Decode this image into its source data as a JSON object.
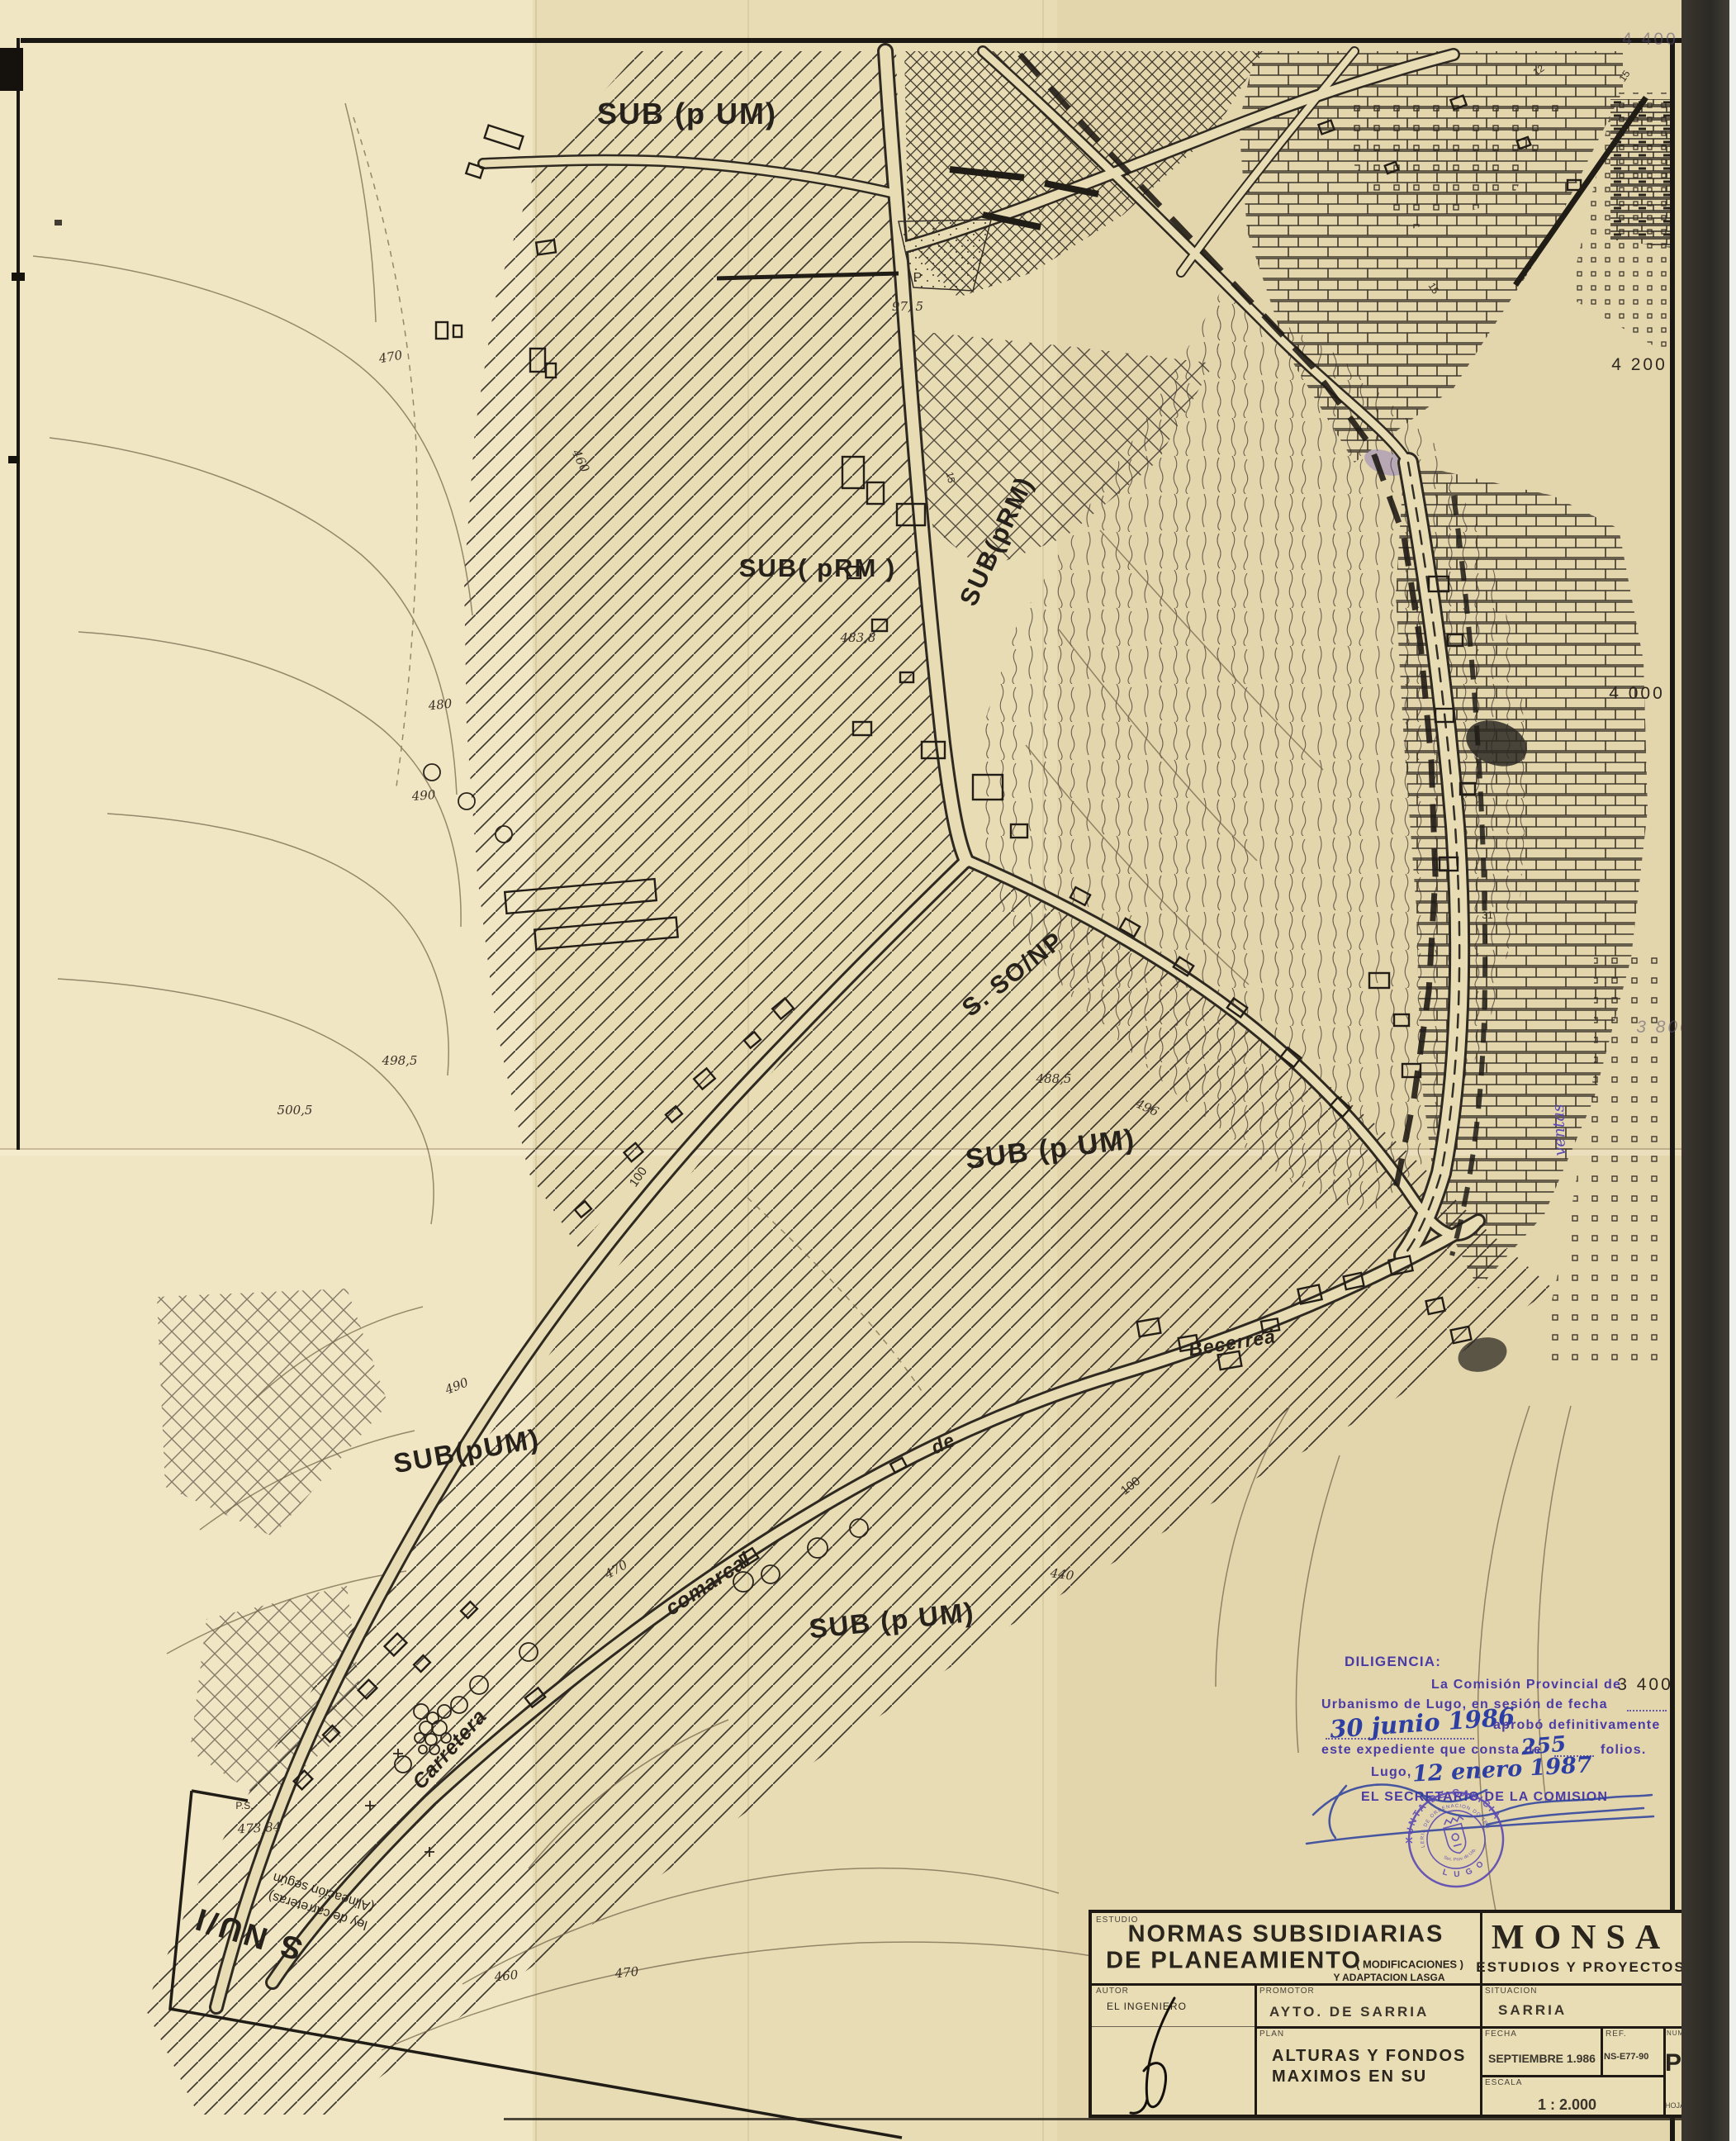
{
  "map": {
    "zone_labels": [
      {
        "text": "SUB (p UM)"
      },
      {
        "text": "SUB( pRM )"
      },
      {
        "text": "SUB(pRM)"
      },
      {
        "text": "S. SO/NP"
      },
      {
        "text": "SUB (p UM)"
      },
      {
        "text": "SUB(pUM)"
      },
      {
        "text": "SUB (p UM)"
      },
      {
        "text": "S NU/I"
      }
    ],
    "snu_note_line1": "(Alineación según",
    "snu_note_line2": "ley de carreteras)",
    "road_names": [
      {
        "text": "Carretera"
      },
      {
        "text": "comarcal"
      },
      {
        "text": "de"
      },
      {
        "text": "Becerreá"
      },
      {
        "text": "ventas"
      }
    ],
    "grid_labels": [
      {
        "text": "4 400"
      },
      {
        "text": "4 200"
      },
      {
        "text": "4 000"
      },
      {
        "text": "3 800"
      },
      {
        "text": "3 400"
      }
    ],
    "spot_elevations": [
      {
        "text": "470"
      },
      {
        "text": "460"
      },
      {
        "text": "480"
      },
      {
        "text": "490"
      },
      {
        "text": "498,5"
      },
      {
        "text": "500,5"
      },
      {
        "text": "483,8"
      },
      {
        "text": "488,5"
      },
      {
        "text": "496"
      },
      {
        "text": "490"
      },
      {
        "text": "470"
      },
      {
        "text": "460"
      },
      {
        "text": "470"
      },
      {
        "text": "440"
      },
      {
        "text": "473,84"
      },
      {
        "text": "97, 5"
      }
    ],
    "small_numbers": [
      {
        "text": "P"
      },
      {
        "text": "P.S."
      },
      {
        "text": "15"
      },
      {
        "text": "31"
      },
      {
        "text": "12"
      },
      {
        "text": "15"
      },
      {
        "text": "15"
      },
      {
        "text": "100"
      },
      {
        "text": "100"
      }
    ]
  },
  "diligencia": {
    "heading": "DILIGENCIA:",
    "line1": "La Comisión Provincial de",
    "line2": "Urbanismo de Lugo, en sesión de fecha",
    "hand_date1": "30 junio 1986",
    "line3": "aprobó definitivamente",
    "line4a": "este expediente que consta de",
    "hand_folios": "255",
    "line4b": "folios.",
    "line5": "Lugo,",
    "hand_date2": "12 enero 1987",
    "line6": "EL SECRETARIO DE LA COMISION",
    "seal": {
      "outer": "XUNTA DE GALICIA",
      "inner": "CONSELLERIA DE ORDENACION DO TERRITORIO",
      "bottom": "L U G O",
      "center": "Sec. Prov. de Urb."
    }
  },
  "title_block": {
    "estudio_label": "ESTUDIO",
    "estudio_line1": "NORMAS SUBSIDIARIAS",
    "estudio_line2": "DE PLANEAMIENTO",
    "estudio_paren": "( MODIFICACIONES )",
    "estudio_line3": "Y ADAPTACION LASGA",
    "firm_name": "MONSA",
    "firm_sub": "ESTUDIOS Y PROYECTOS",
    "autor_label": "AUTOR",
    "autor_value": "EL INGENIERO",
    "promotor_label": "PROMOTOR",
    "promotor_value": "AYTO. DE SARRIA",
    "situacion_label": "SITUACION",
    "situacion_value": "SARRIA",
    "plan_label": "PLAN",
    "plan_line1": "ALTURAS Y FONDOS",
    "plan_line2": "MAXIMOS EN SU",
    "fecha_label": "FECHA",
    "fecha_value": "SEPTIEMBRE 1.986",
    "ref_label": "REF.",
    "ref_value": "NS-E77-90",
    "numero_label": "NUMERO",
    "numero_value": "P/2",
    "escala_label": "ESCALA",
    "escala_value": "1 : 2.000",
    "hoja_value": "HOJA Nº 4"
  },
  "colors": {
    "paper": "#e8dcb4",
    "ink": "#2b251d",
    "stamp_purple": "#5b49b4",
    "hand_blue": "#2e3fa3"
  }
}
